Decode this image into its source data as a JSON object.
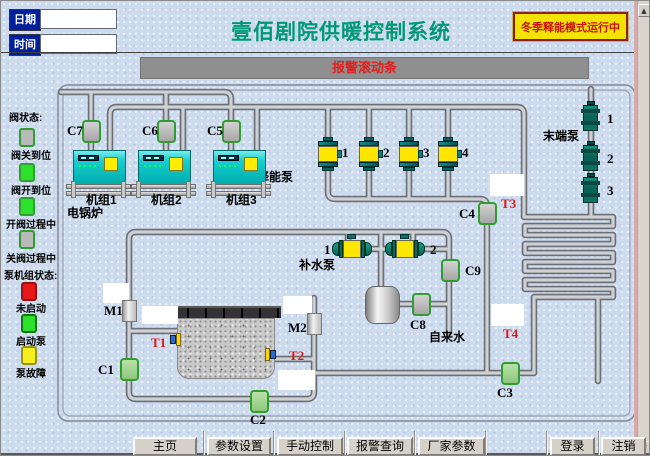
{
  "header": {
    "date_label": "日期",
    "time_label": "时间",
    "date_value": "",
    "time_value": "",
    "title": "壹佰剧院供暖控制系统",
    "mode_button_label": "冬季释能模式运行中",
    "alarm_text": "报警滚动条"
  },
  "legend": {
    "valve_section_title": "阀状态:",
    "valve_states": [
      {
        "label": "阀关到位",
        "color": "#b9b9b9",
        "border": "#2f9e2f",
        "y": 127,
        "ly": 146
      },
      {
        "label": "阀开到位",
        "color": "#2ee02e",
        "border": "#2f9e2f",
        "y": 162,
        "ly": 181
      },
      {
        "label": "开阀过程中",
        "color": "#2ee02e",
        "border": "#2f9e2f",
        "y": 196,
        "ly": 215
      },
      {
        "label": "关阀过程中",
        "color": "#b9b9b9",
        "border": "#2f9e2f",
        "y": 229,
        "ly": 249
      }
    ],
    "pump_section_title": "泵机组状态:",
    "pump_states": [
      {
        "label": "未启动",
        "color": "#e81818",
        "border": "#991111",
        "y": 281,
        "ly": 299
      },
      {
        "label": "启动泵",
        "color": "#2ee02e",
        "border": "#117711",
        "y": 313,
        "ly": 332
      },
      {
        "label": "泵故障",
        "color": "#f4ef1d",
        "border": "#9a9311",
        "y": 345,
        "ly": 364
      }
    ]
  },
  "diagram": {
    "labels": {
      "boiler": "电锅炉",
      "release_pumps": "释能泵",
      "end_pumps": "末端泵",
      "makeup_pumps": "补水泵",
      "tap_water": "自来水"
    },
    "units": [
      {
        "label": "机组1",
        "x": 72
      },
      {
        "label": "机组2",
        "x": 137
      },
      {
        "label": "机组3",
        "x": 212
      }
    ],
    "valves": [
      {
        "id": "C7",
        "cx": 90,
        "cy": 130,
        "state": "gray",
        "lx": 66,
        "ly": 123
      },
      {
        "id": "C6",
        "cx": 165,
        "cy": 130,
        "state": "gray",
        "lx": 141,
        "ly": 123
      },
      {
        "id": "C5",
        "cx": 230,
        "cy": 130,
        "state": "gray",
        "lx": 206,
        "ly": 123
      },
      {
        "id": "C4",
        "cx": 486,
        "cy": 212,
        "state": "gray",
        "lx": 458,
        "ly": 206
      },
      {
        "id": "C9",
        "cx": 449,
        "cy": 269,
        "state": "gray",
        "lx": 464,
        "ly": 263
      },
      {
        "id": "C8",
        "cx": 420,
        "cy": 303,
        "state": "gray",
        "lx": 409,
        "ly": 317
      },
      {
        "id": "C1",
        "cx": 128,
        "cy": 368,
        "state": "green",
        "lx": 97,
        "ly": 362
      },
      {
        "id": "C2",
        "cx": 258,
        "cy": 400,
        "state": "green",
        "lx": 249,
        "ly": 412
      },
      {
        "id": "C3",
        "cx": 509,
        "cy": 372,
        "state": "green",
        "lx": 496,
        "ly": 385
      }
    ],
    "meters": [
      {
        "id": "M1",
        "x": 121,
        "y": 299,
        "lx": 103,
        "ly": 303
      },
      {
        "id": "M2",
        "x": 306,
        "y": 312,
        "lx": 287,
        "ly": 320
      }
    ],
    "temps": [
      {
        "id": "T1",
        "lx": 150,
        "ly": 335,
        "sx": 169,
        "sy": 332,
        "flip": false
      },
      {
        "id": "T2",
        "lx": 288,
        "ly": 348,
        "sx": 264,
        "sy": 347,
        "flip": true
      },
      {
        "id": "T3",
        "lx": 500,
        "ly": 196
      },
      {
        "id": "T4",
        "lx": 502,
        "ly": 326
      }
    ],
    "white_boxes": [
      [
        102,
        282,
        26,
        20
      ],
      [
        141,
        305,
        36,
        18
      ],
      [
        282,
        295,
        29,
        18
      ],
      [
        277,
        369,
        37,
        20
      ],
      [
        489,
        173,
        34,
        22
      ],
      [
        490,
        303,
        33,
        22
      ]
    ],
    "release_pumps": {
      "xs": [
        327,
        368,
        408,
        447
      ],
      "y": 136,
      "numbers": [
        "1",
        "2",
        "3",
        "4"
      ]
    },
    "end_pumps": {
      "cx": 590,
      "ys": [
        100,
        140,
        172
      ],
      "numbers": [
        "1",
        "2",
        "3"
      ]
    },
    "makeup_pumps": {
      "y": 237,
      "items": [
        {
          "x": 331,
          "number": "1"
        },
        {
          "x": 384,
          "number": "2"
        }
      ]
    }
  },
  "footer": {
    "nav_buttons": [
      "主页",
      "参数设置",
      "手动控制",
      "报警查询",
      "厂家参数"
    ],
    "auth_buttons": [
      "登录",
      "注销"
    ]
  },
  "scrollbar": {
    "up": "▲",
    "down": "▼"
  }
}
